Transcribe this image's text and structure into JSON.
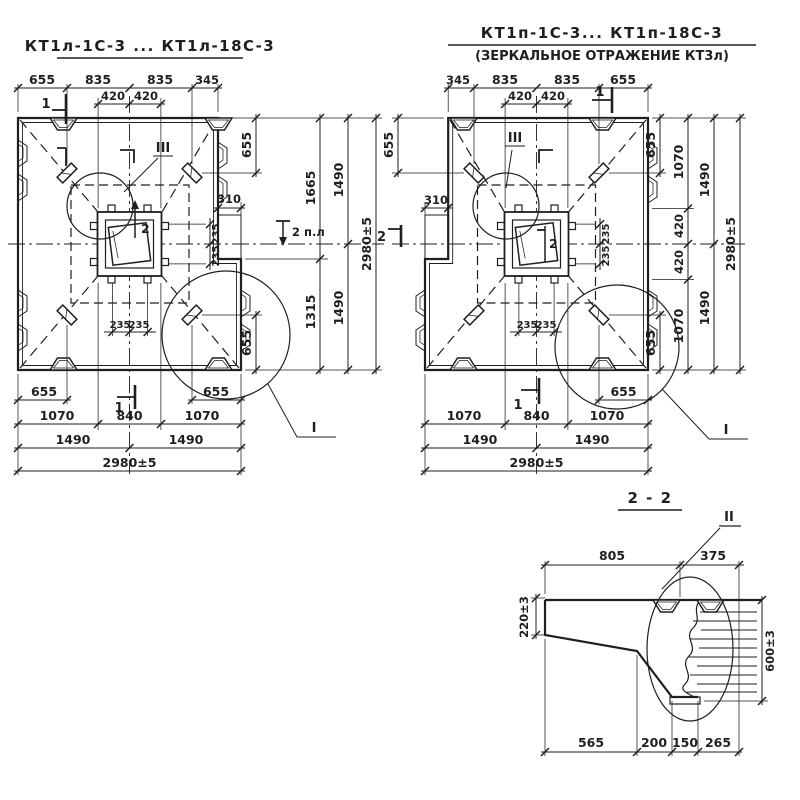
{
  "sheet": {
    "paper": "#ffffff",
    "ink": "#1f1f1f"
  },
  "left_view": {
    "title": "КТ1л-1С-3 ... КТ1л-18С-3",
    "top": [
      "655",
      "835",
      "835",
      "345"
    ],
    "top420": [
      "420",
      "420"
    ],
    "b655l": "655",
    "b655r": "655",
    "brow": [
      "1070",
      "840",
      "1070"
    ],
    "brow2": [
      "1490",
      "1490"
    ],
    "overall": "2980±5",
    "r655t": "655",
    "r655b": "655",
    "r1665": "1665",
    "r1315": "1315",
    "r1490a": "1490",
    "r1490b": "1490",
    "roverall": "2980±5",
    "d310": "310",
    "h235": [
      "235",
      "235"
    ],
    "v235": [
      "235",
      "235"
    ],
    "lIII": "III",
    "lI": "I",
    "m1t": "1",
    "m1b": "1",
    "m2c": "2",
    "m2r": "2 п.л"
  },
  "right_view": {
    "title": "КТ1п-1С-3... КТ1п-18С-3",
    "subtitle": "(ЗЕРКАЛЬНОЕ ОТРАЖЕНИЕ КТ3л)",
    "top": [
      "345",
      "835",
      "835",
      "655"
    ],
    "top420": [
      "420",
      "420"
    ],
    "b655r": "655",
    "brow": [
      "1070",
      "840",
      "1070"
    ],
    "brow2": [
      "1490",
      "1490"
    ],
    "overall": "2980±5",
    "l655": "655",
    "d310": "310",
    "r655t": "655",
    "r655b": "655",
    "r1070a": "1070",
    "r420a": "420",
    "r420b": "420",
    "r1070b": "1070",
    "r1490a": "1490",
    "r1490b": "1490",
    "roverall": "2980±5",
    "h235": [
      "235",
      "235"
    ],
    "v235": [
      "235",
      "235"
    ],
    "lIII": "III",
    "lI": "I",
    "m1t": "1",
    "m1b": "1",
    "m2c": "2",
    "m2l": "2"
  },
  "section": {
    "title": "2 - 2",
    "lII": "II",
    "d805": "805",
    "d375": "375",
    "d220": "220±3",
    "d600": "600±3",
    "bottom": [
      "565",
      "200",
      "150",
      "265"
    ]
  }
}
